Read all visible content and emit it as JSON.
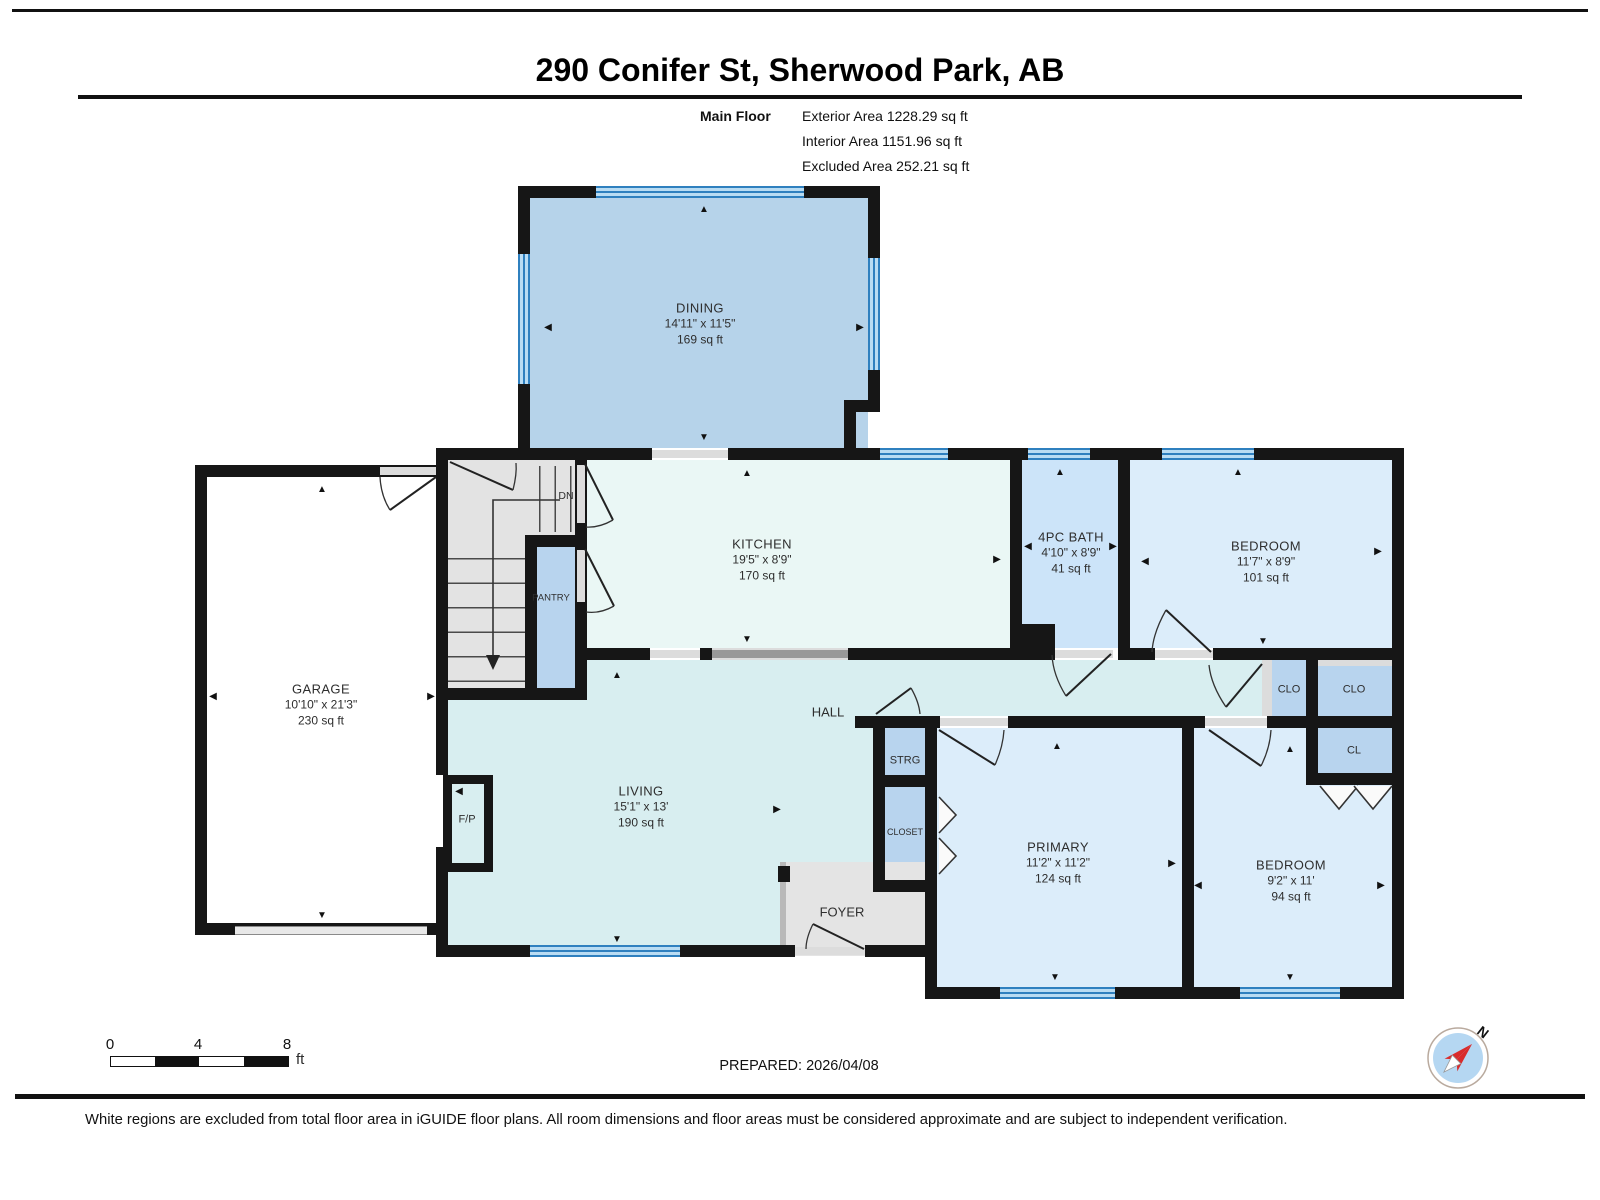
{
  "header": {
    "title": "290 Conifer St, Sherwood Park, AB",
    "floor_label": "Main Floor",
    "area_lines": [
      "Exterior Area 1228.29 sq ft",
      "Interior Area 1151.96 sq ft",
      "Excluded Area 252.21 sq ft"
    ]
  },
  "rooms": [
    {
      "name": "DINING",
      "dims": "14'11\" x 11'5\"",
      "area": "169 sq ft"
    },
    {
      "name": "KITCHEN",
      "dims": "19'5\" x 8'9\"",
      "area": "170 sq ft"
    },
    {
      "name": "4PC BATH",
      "dims": "4'10\" x 8'9\"",
      "area": "41 sq ft"
    },
    {
      "name": "BEDROOM",
      "dims": "11'7\" x 8'9\"",
      "area": "101 sq ft"
    },
    {
      "name": "GARAGE",
      "dims": "10'10\" x 21'3\"",
      "area": "230 sq ft"
    },
    {
      "name": "LIVING",
      "dims": "15'1\" x 13'",
      "area": "190 sq ft"
    },
    {
      "name": "PRIMARY",
      "dims": "11'2\" x 11'2\"",
      "area": "124 sq ft"
    },
    {
      "name": "BEDROOM",
      "dims": "9'2\" x 11'",
      "area": "94 sq ft"
    }
  ],
  "labels": {
    "hall": "HALL",
    "foyer": "FOYER",
    "pantry": "PANTRY",
    "strg": "STRG",
    "closet": "CLOSET",
    "fp": "F/P",
    "dn": "DN",
    "clo_left": "CLO",
    "clo_right": "CLO",
    "cl": "CL"
  },
  "icons": {
    "up": "▲",
    "down": "▼",
    "left": "◀",
    "right": "▶"
  },
  "scale_bar": {
    "t0": "0",
    "t4": "4",
    "t8": "8",
    "unit": "ft"
  },
  "footer": {
    "prepared": "PREPARED: 2026/04/08",
    "disclaimer": "White regions are excluded from total floor area in iGUIDE floor plans. All room dimensions and floor areas must be considered approximate and are subject to independent verification."
  },
  "compass": {
    "label": "N"
  },
  "colors": {
    "wall": "#161616",
    "dining": "#b6d3ea",
    "kitchen": "#eaf7f5",
    "living_hall": "#d8eef0",
    "bedroom": "#dcedfa",
    "bath": "#cce4f9",
    "closet": "#b8d4ee",
    "foyer_stairs": "#e3e3e3",
    "window": "#2f80bf",
    "compass_red": "#d92b2b",
    "compass_blue": "#b5d7f2"
  }
}
